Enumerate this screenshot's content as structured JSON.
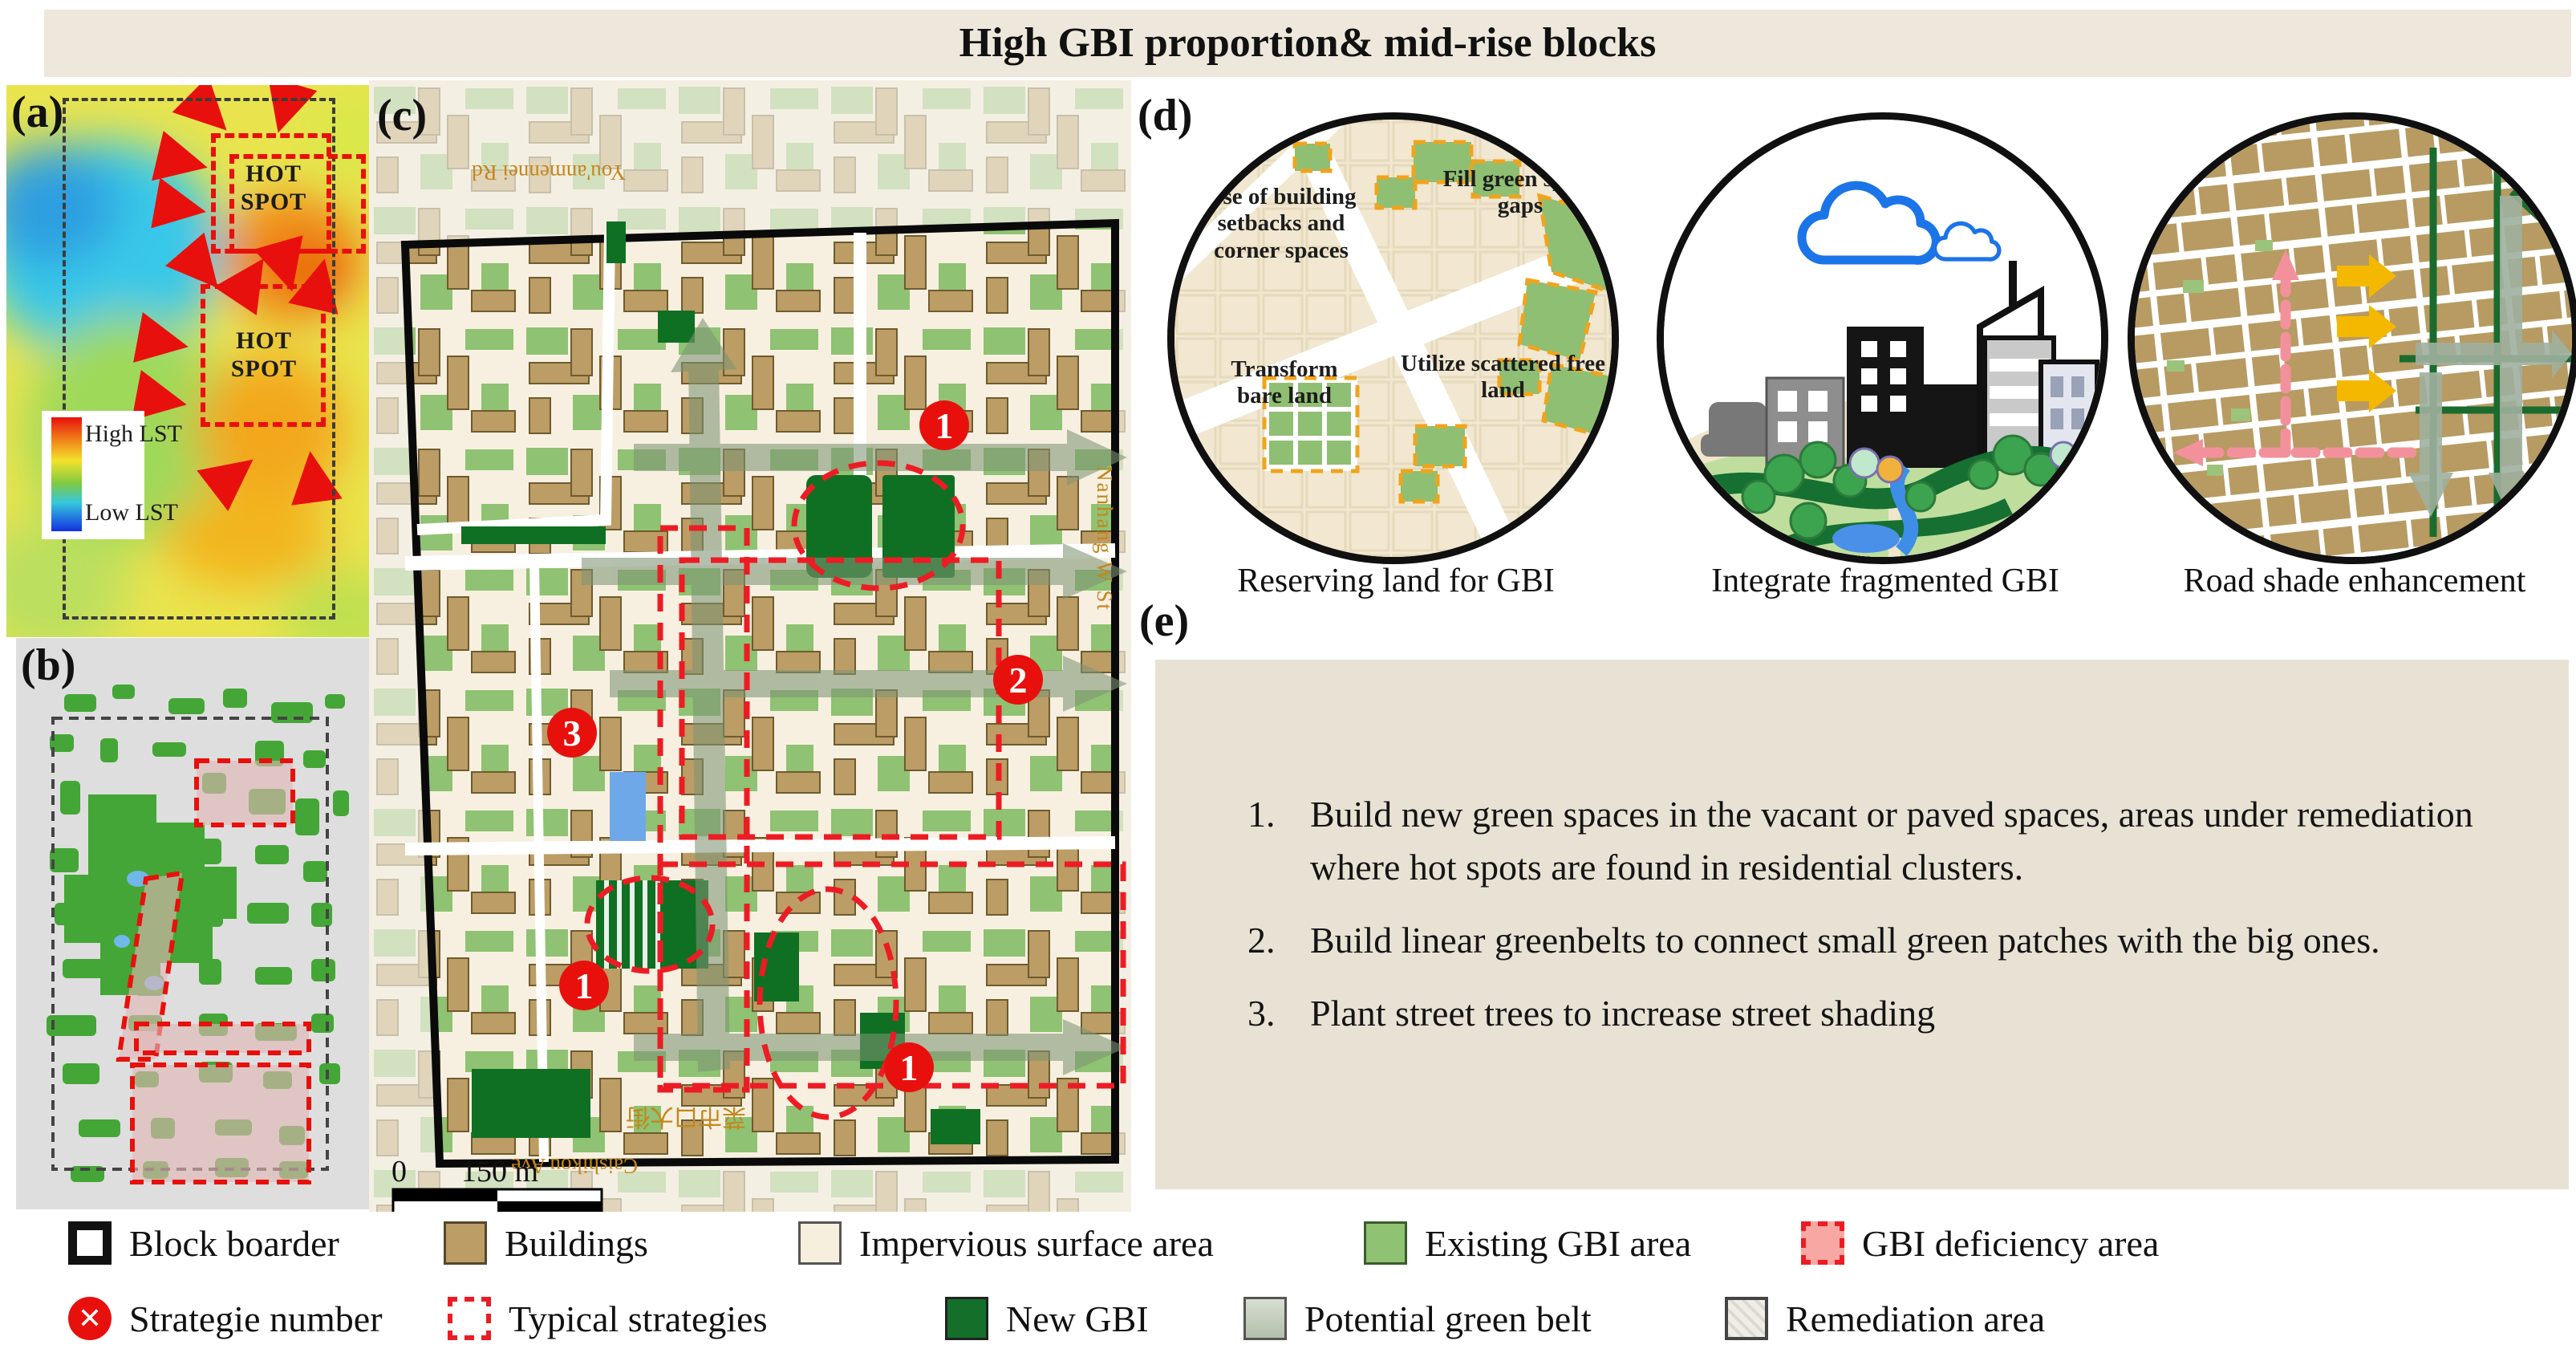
{
  "title": {
    "text": "High GBI proportion& mid-rise blocks"
  },
  "panel_a": {
    "label": "(a)",
    "hot_spot_top": "HOT SPOT",
    "hot_spot_bottom": "HOT SPOT",
    "lst_high": "High LST",
    "lst_low": "Low LST"
  },
  "panel_b": {
    "label": "(b)"
  },
  "panel_c": {
    "label": "(c)",
    "marker_1a": "1",
    "marker_2": "2",
    "marker_3": "3",
    "marker_1b": "1",
    "marker_1c": "1",
    "scale_zero": "0",
    "scale_label": "150 m",
    "street_top": "You'anmennei Rd",
    "street_right": "Nanhang W St",
    "street_bottom_cn": "菜市口大街",
    "street_bottom_en": "Caishikou Ave"
  },
  "panel_d": {
    "label": "(d)",
    "circle1": {
      "caption": "Reserving land for GBI",
      "label_setbacks": "Use of building setbacks and corner spaces",
      "label_fill": "Fill green space gaps",
      "label_bare": "Transform bare land",
      "label_scattered": "Utilize scattered free land"
    },
    "circle2": {
      "caption": "Integrate fragmented GBI"
    },
    "circle3": {
      "caption": "Road shade enhancement"
    }
  },
  "panel_e": {
    "label": "(e)",
    "nums": [
      "1.",
      "2.",
      "3."
    ],
    "items": [
      "Build new green spaces in the vacant or paved spaces, areas under remediation where hot spots are found in residential clusters.",
      "Build linear greenbelts to connect small green patches with the big ones.",
      "Plant street trees to increase street shading"
    ]
  },
  "legend": {
    "block_border": "Block boarder",
    "buildings": "Buildings",
    "impervious": "Impervious surface area",
    "existing_gbi": "Existing GBI area",
    "gbi_deficiency": "GBI deficiency area",
    "strategy_number": "Strategie number",
    "typical_strategies": "Typical strategies",
    "new_gbi": "New GBI",
    "potential_green_belt": "Potential green belt",
    "remediation": "Remediation area"
  },
  "colors": {
    "title_bg": "#EDE8DB",
    "panel_e_bg": "#E8E2D4",
    "buildings": "#BB9D65",
    "impervious": "#F6EFDE",
    "existing_gbi": "#8FC272",
    "new_gbi": "#136F2A",
    "deficiency_red": "#EC1C24",
    "potential_green_belt": "#8FA386",
    "strategy_red": "#E8100C"
  }
}
